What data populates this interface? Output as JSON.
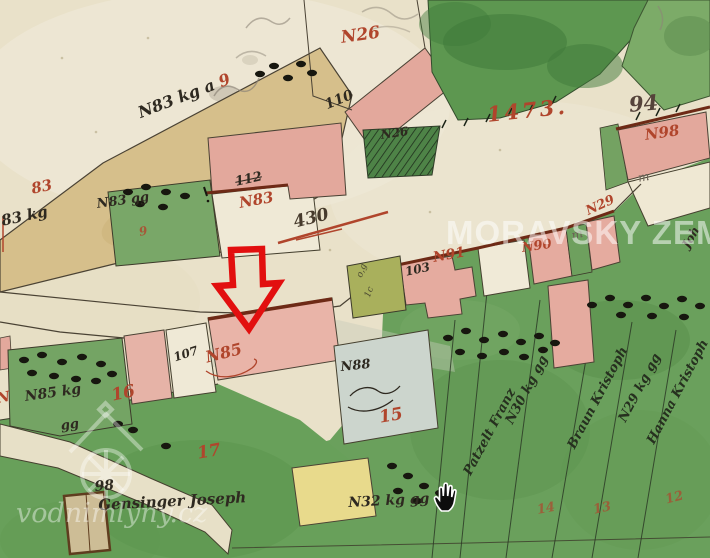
{
  "colors": {
    "annotation_red": "#e20f0f",
    "ink_red": "#b0452c",
    "ink_black": "#2e2920",
    "paper": "#e9e1c9",
    "watermark_white": "rgba(255,255,255,0.5)"
  },
  "watermarks": {
    "archive": "MORAVSKY ZEMS",
    "site": "vodnimlyny.cz"
  },
  "cursor": {
    "type": "open-hand"
  },
  "annotation": {
    "type": "red-outline-arrow-down"
  },
  "labels": {
    "red": {
      "n26": "N26",
      "digit9": "9",
      "p83": "83",
      "small9": "9",
      "n83": "N83",
      "plot1473": "1473.",
      "n98": "N98",
      "n91": "N91",
      "n90": "N90",
      "n29": "N29",
      "r16": "16",
      "r17": "17",
      "r15": "15",
      "n85": "N85",
      "r14": "14",
      "r13": "13",
      "r12": "12",
      "edge_n": "N"
    },
    "pencil": {
      "p94": "94",
      "m1": "m",
      "m2": "m",
      "tiny1": "o,g",
      "tiny2": "1c"
    },
    "black": {
      "strip83": "N83 kg a",
      "h110": "110",
      "h112": "112",
      "n83gg": "N83 gg",
      "kg83": "83 kg",
      "n26h": "N26",
      "h103": "103",
      "h107": "107",
      "n85kg": "N85 kg",
      "gg": "gg",
      "n88": "N88",
      "p98": "98",
      "crossed": "430",
      "owner": "Gensinger Joseph",
      "plot32": "N32 kg gg",
      "joh": "Joh"
    },
    "strips": [
      {
        "text": "Patzelt Franz"
      },
      {
        "text": "N30 kg gg"
      },
      {
        "text": "Braun Kristoph"
      },
      {
        "text": "N29 kg gg"
      },
      {
        "text": "Hanna Kristoph"
      }
    ]
  }
}
